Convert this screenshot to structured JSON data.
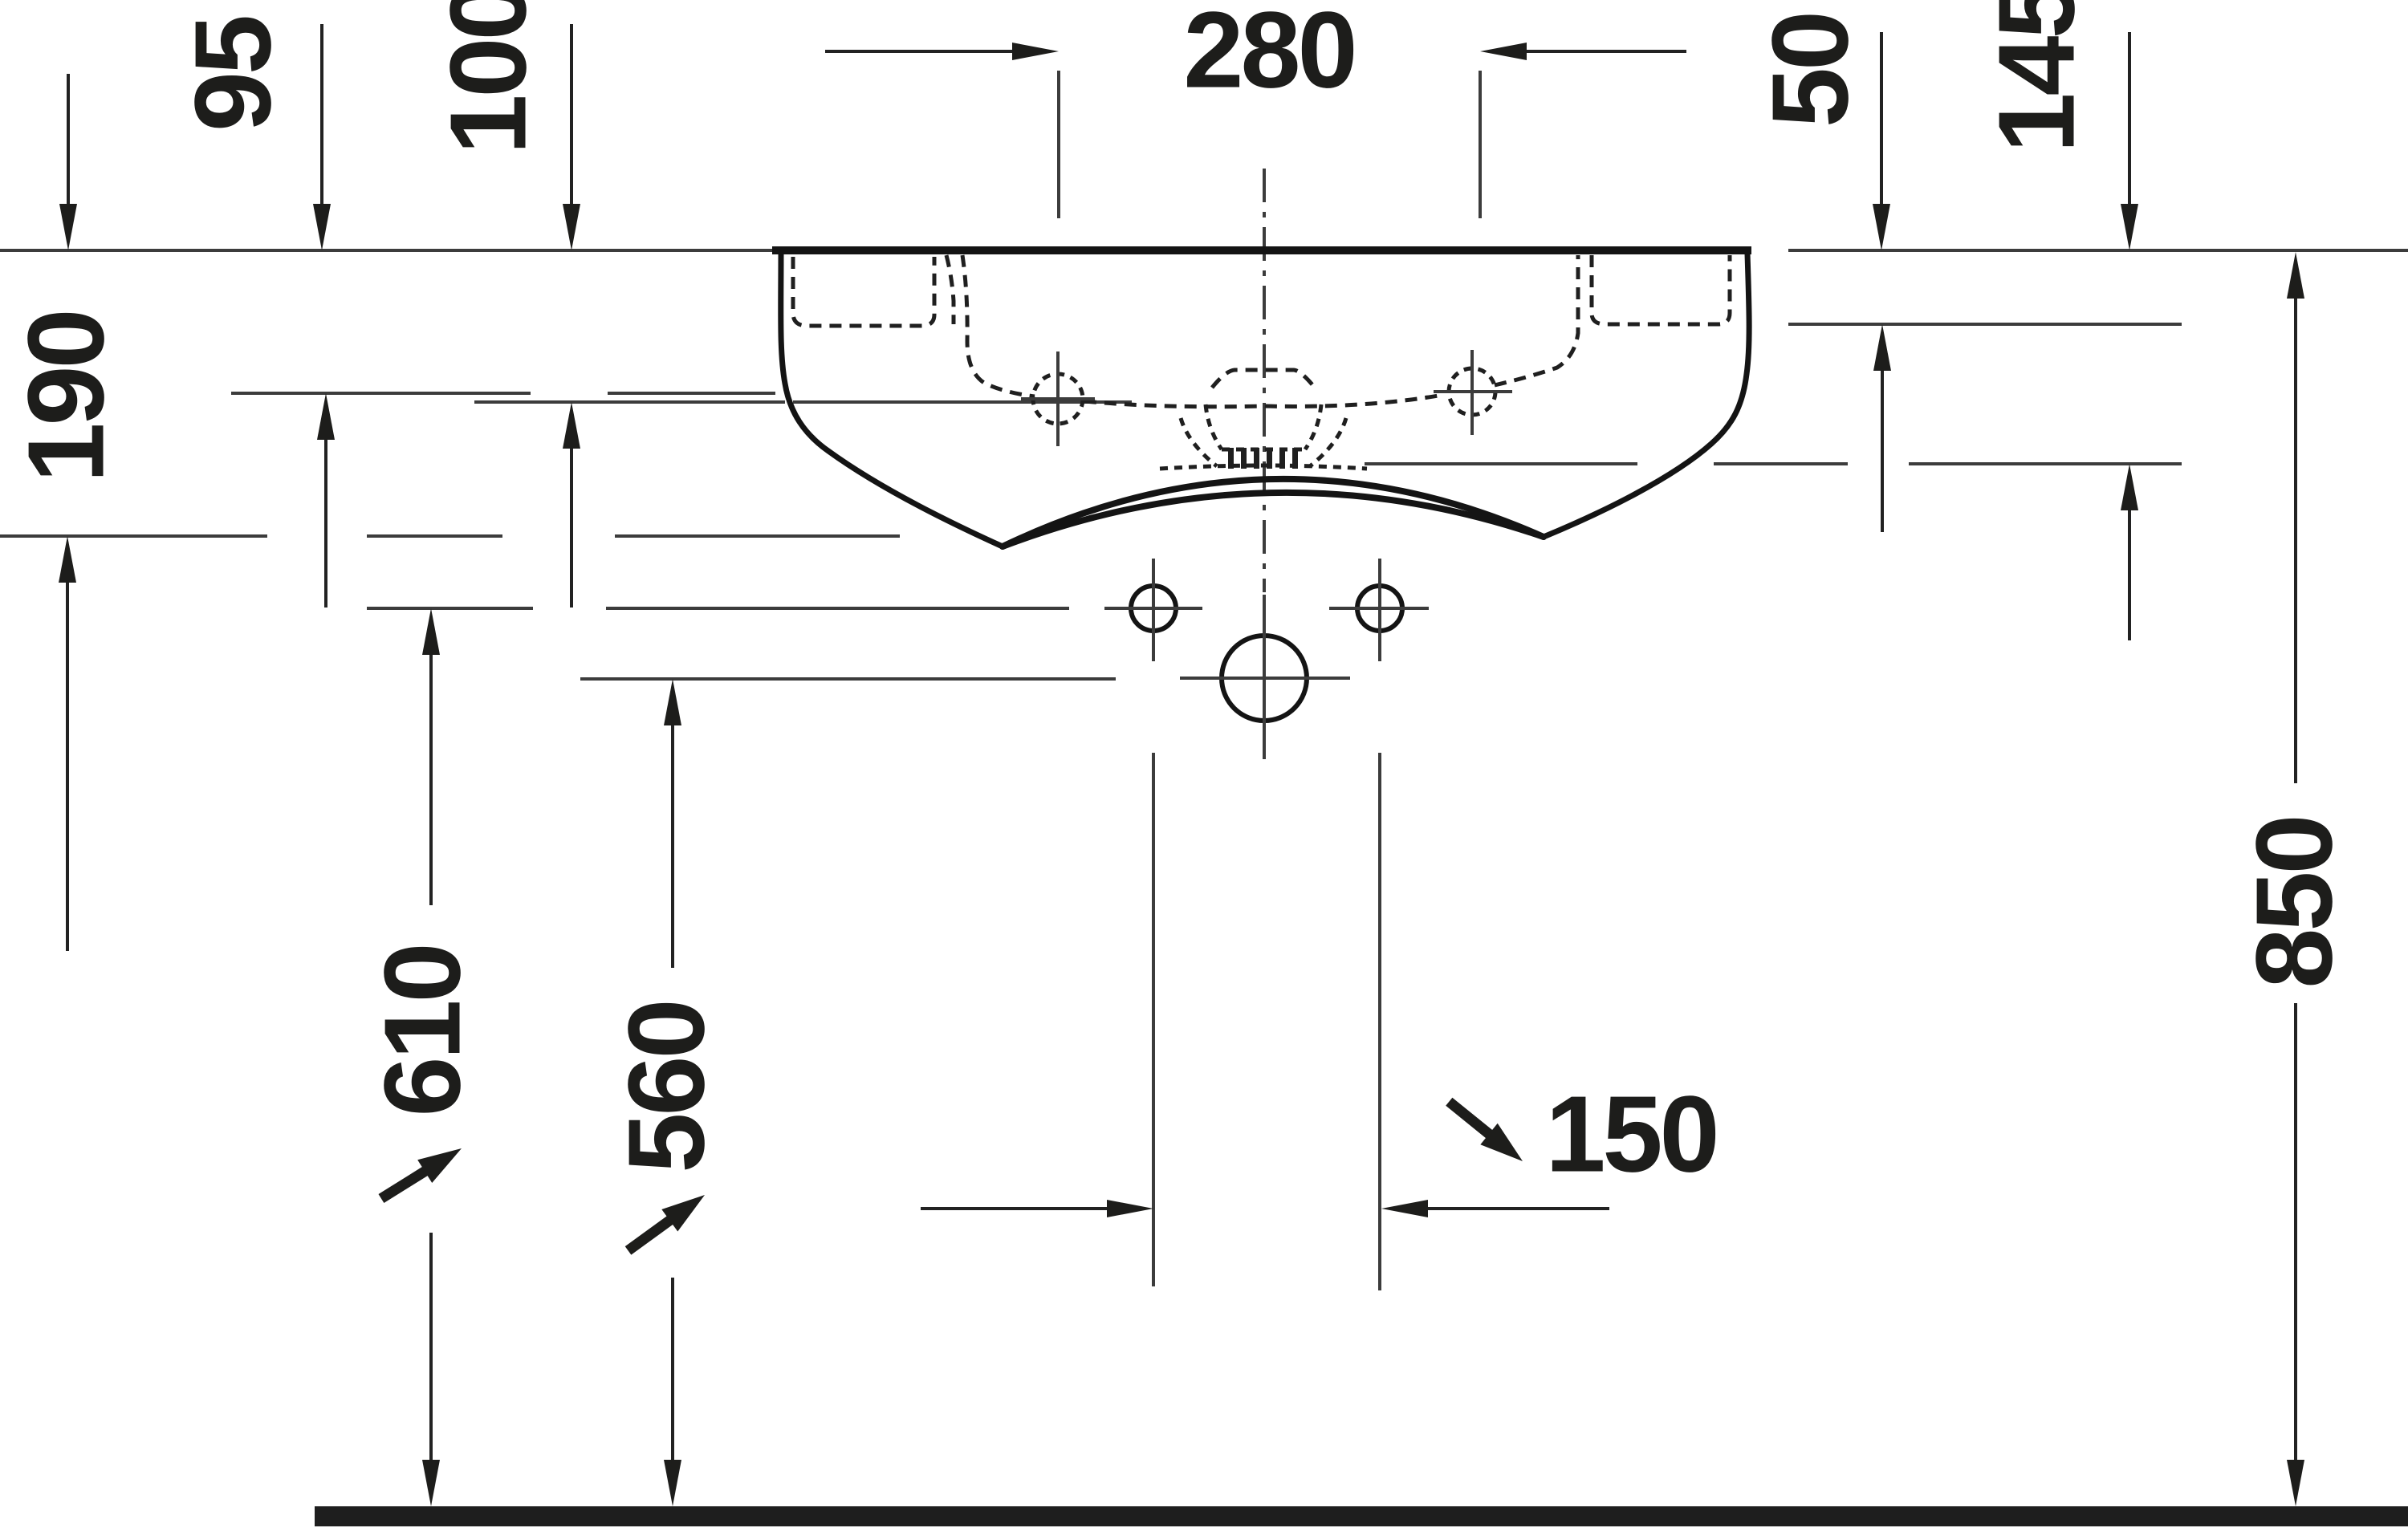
{
  "diagram": {
    "type": "technical-drawing",
    "subject": "wall-mounted washbasin, front elevation with installation dimensions",
    "units": "mm",
    "colors": {
      "ink": "#1d1d1b",
      "reference_line": "#3c3c3c",
      "floor": "#1e1e1e",
      "background": "#ffffff"
    },
    "dimensions": {
      "d95": "95",
      "d100": "100",
      "d190": "190",
      "d280": "280",
      "d50": "50",
      "d145": "145",
      "d610": "610",
      "d560": "560",
      "d850": "850",
      "d150": "150"
    }
  }
}
